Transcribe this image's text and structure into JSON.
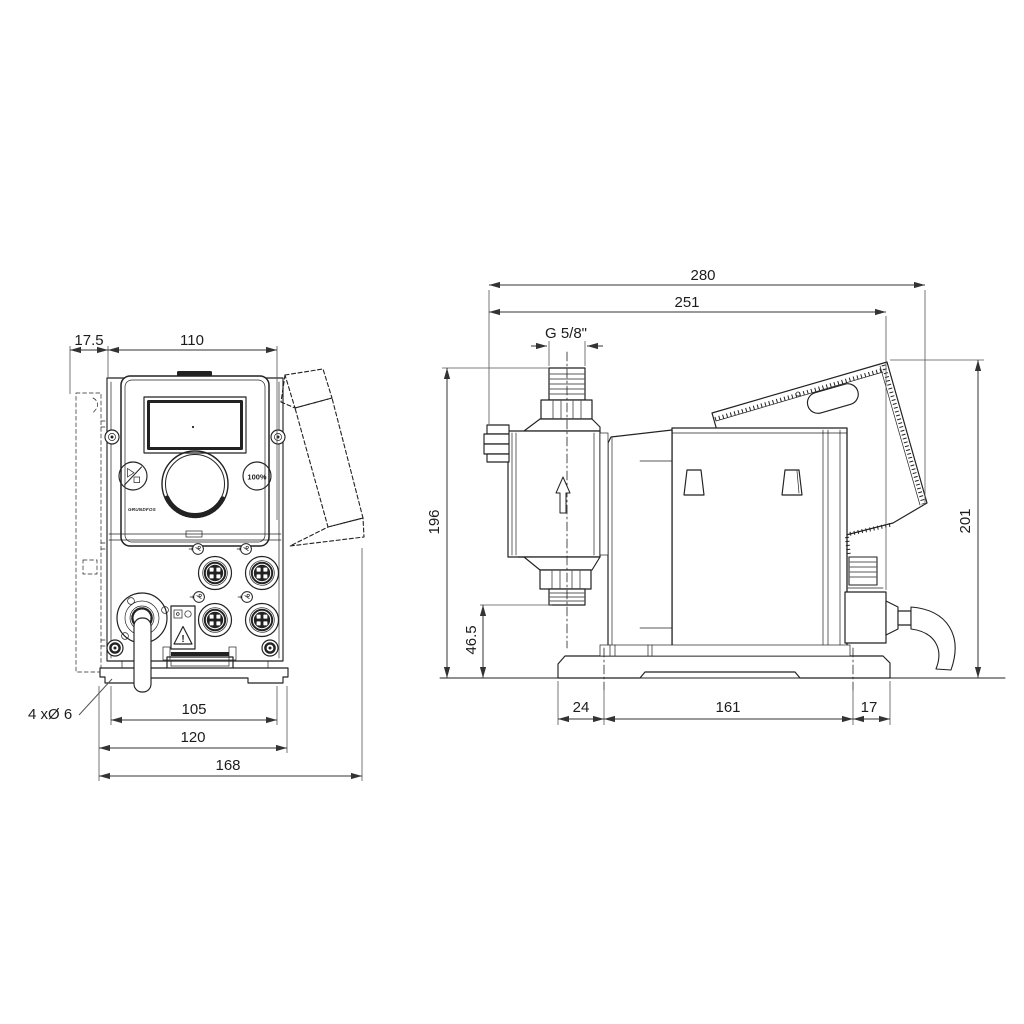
{
  "views": {
    "front": {
      "dims": {
        "offset": "17.5",
        "width": "110",
        "bolt_spacing": "105",
        "base_width": "120",
        "overall_width": "168",
        "mounting_holes": "4 xØ 6"
      },
      "panel": {
        "capacity_button": "100%",
        "brand": "GRUNDFOS",
        "warning_mark": "!"
      }
    },
    "side": {
      "dims": {
        "overall_depth": "280",
        "depth_to_plug": "251",
        "connection_thread": "G 5/8\"",
        "height": "196",
        "valve_clearance": "46.5",
        "base_front_offset": "24",
        "base_length": "161",
        "base_rear_offset": "17",
        "overall_height": "201"
      }
    }
  },
  "colors": {
    "line": "#222222",
    "dim_text": "#1c1c1c",
    "background": "#ffffff"
  }
}
